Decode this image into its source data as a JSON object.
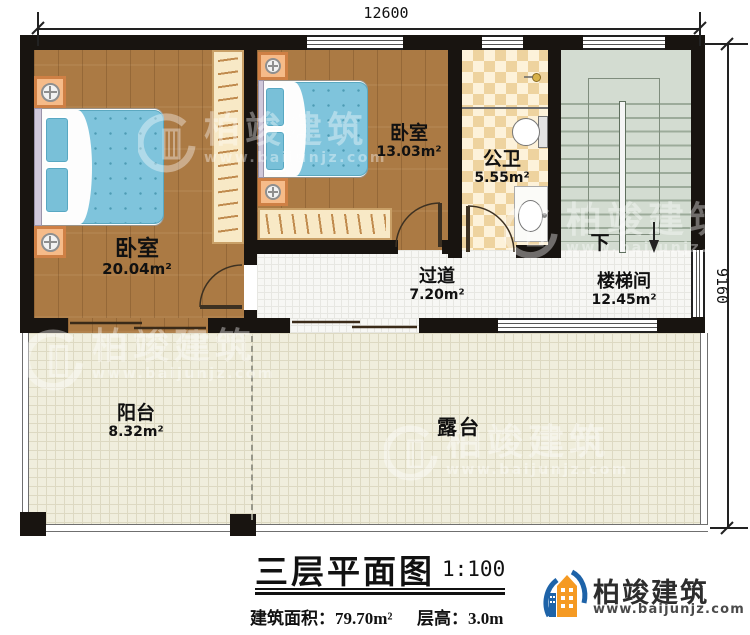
{
  "dimensions": {
    "width_label": "12600",
    "height_label": "9160"
  },
  "rooms": {
    "bedroom1": {
      "name": "卧室",
      "area": "20.04m²"
    },
    "bedroom2": {
      "name": "卧室",
      "area": "13.03m²"
    },
    "bathroom": {
      "name": "公卫",
      "area": "5.55m²"
    },
    "hallway": {
      "name": "过道",
      "area": "7.20m²"
    },
    "stairwell": {
      "name": "楼梯间",
      "area": "12.45m²"
    },
    "balcony": {
      "name": "阳台",
      "area": "8.32m²"
    },
    "terrace": {
      "name": "露台"
    }
  },
  "stairs": {
    "direction_label": "下"
  },
  "title_block": {
    "title": "三层平面图",
    "scale": "1:100",
    "area_label": "建筑面积：",
    "area_value": "79.70m²",
    "floor_height_label": "层高：",
    "floor_height_value": "3.0m"
  },
  "branding": {
    "company": "柏竣建筑",
    "website": "www.baijunjz.com"
  },
  "watermark": {
    "text": "柏竣建筑",
    "url": "www.baijunjz.com"
  },
  "colors": {
    "wall": "#181410",
    "wood_floor": "#ab7a44",
    "bed_blue": "#7fc4dc",
    "bath_tile": "#eed39f",
    "stair_green": "#d3dcd1",
    "terrace_cream": "#f0eedd",
    "logo_blue": "#1e63a8",
    "logo_orange": "#f59a23"
  }
}
